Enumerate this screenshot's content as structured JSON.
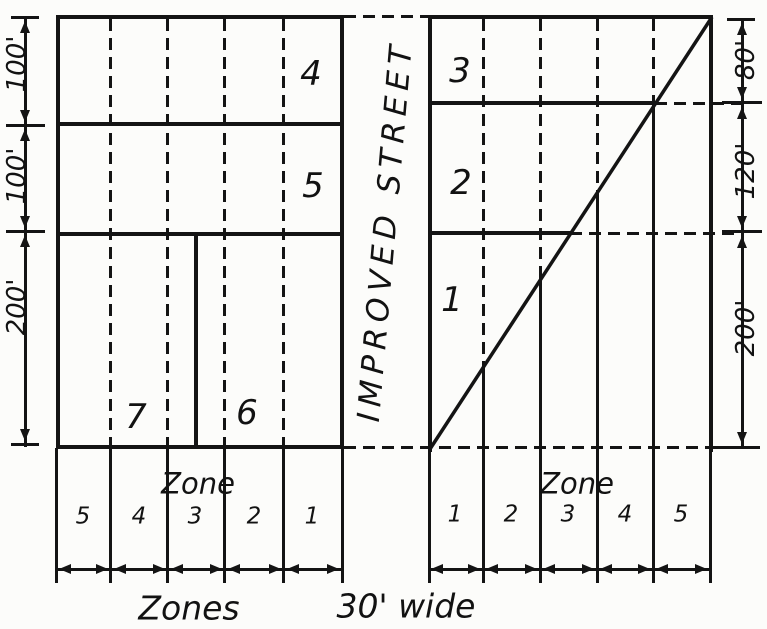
{
  "street_label": "IMPROVED STREET",
  "left": {
    "regions": [
      "4",
      "5",
      "7",
      "6"
    ],
    "depths": [
      "100'",
      "100'",
      "200'"
    ],
    "zone_header": "Zone",
    "zones": [
      "5",
      "4",
      "3",
      "2",
      "1"
    ]
  },
  "right": {
    "regions": [
      "3",
      "2",
      "1"
    ],
    "depths": [
      "80'",
      "120'",
      "200'"
    ],
    "zone_header": "Zone",
    "zones": [
      "1",
      "2",
      "3",
      "4",
      "5"
    ]
  },
  "caption": {
    "zones": "Zones",
    "width": "30' wide"
  },
  "colors": {
    "ink": "#141414",
    "paper": "#fcfcfa"
  }
}
